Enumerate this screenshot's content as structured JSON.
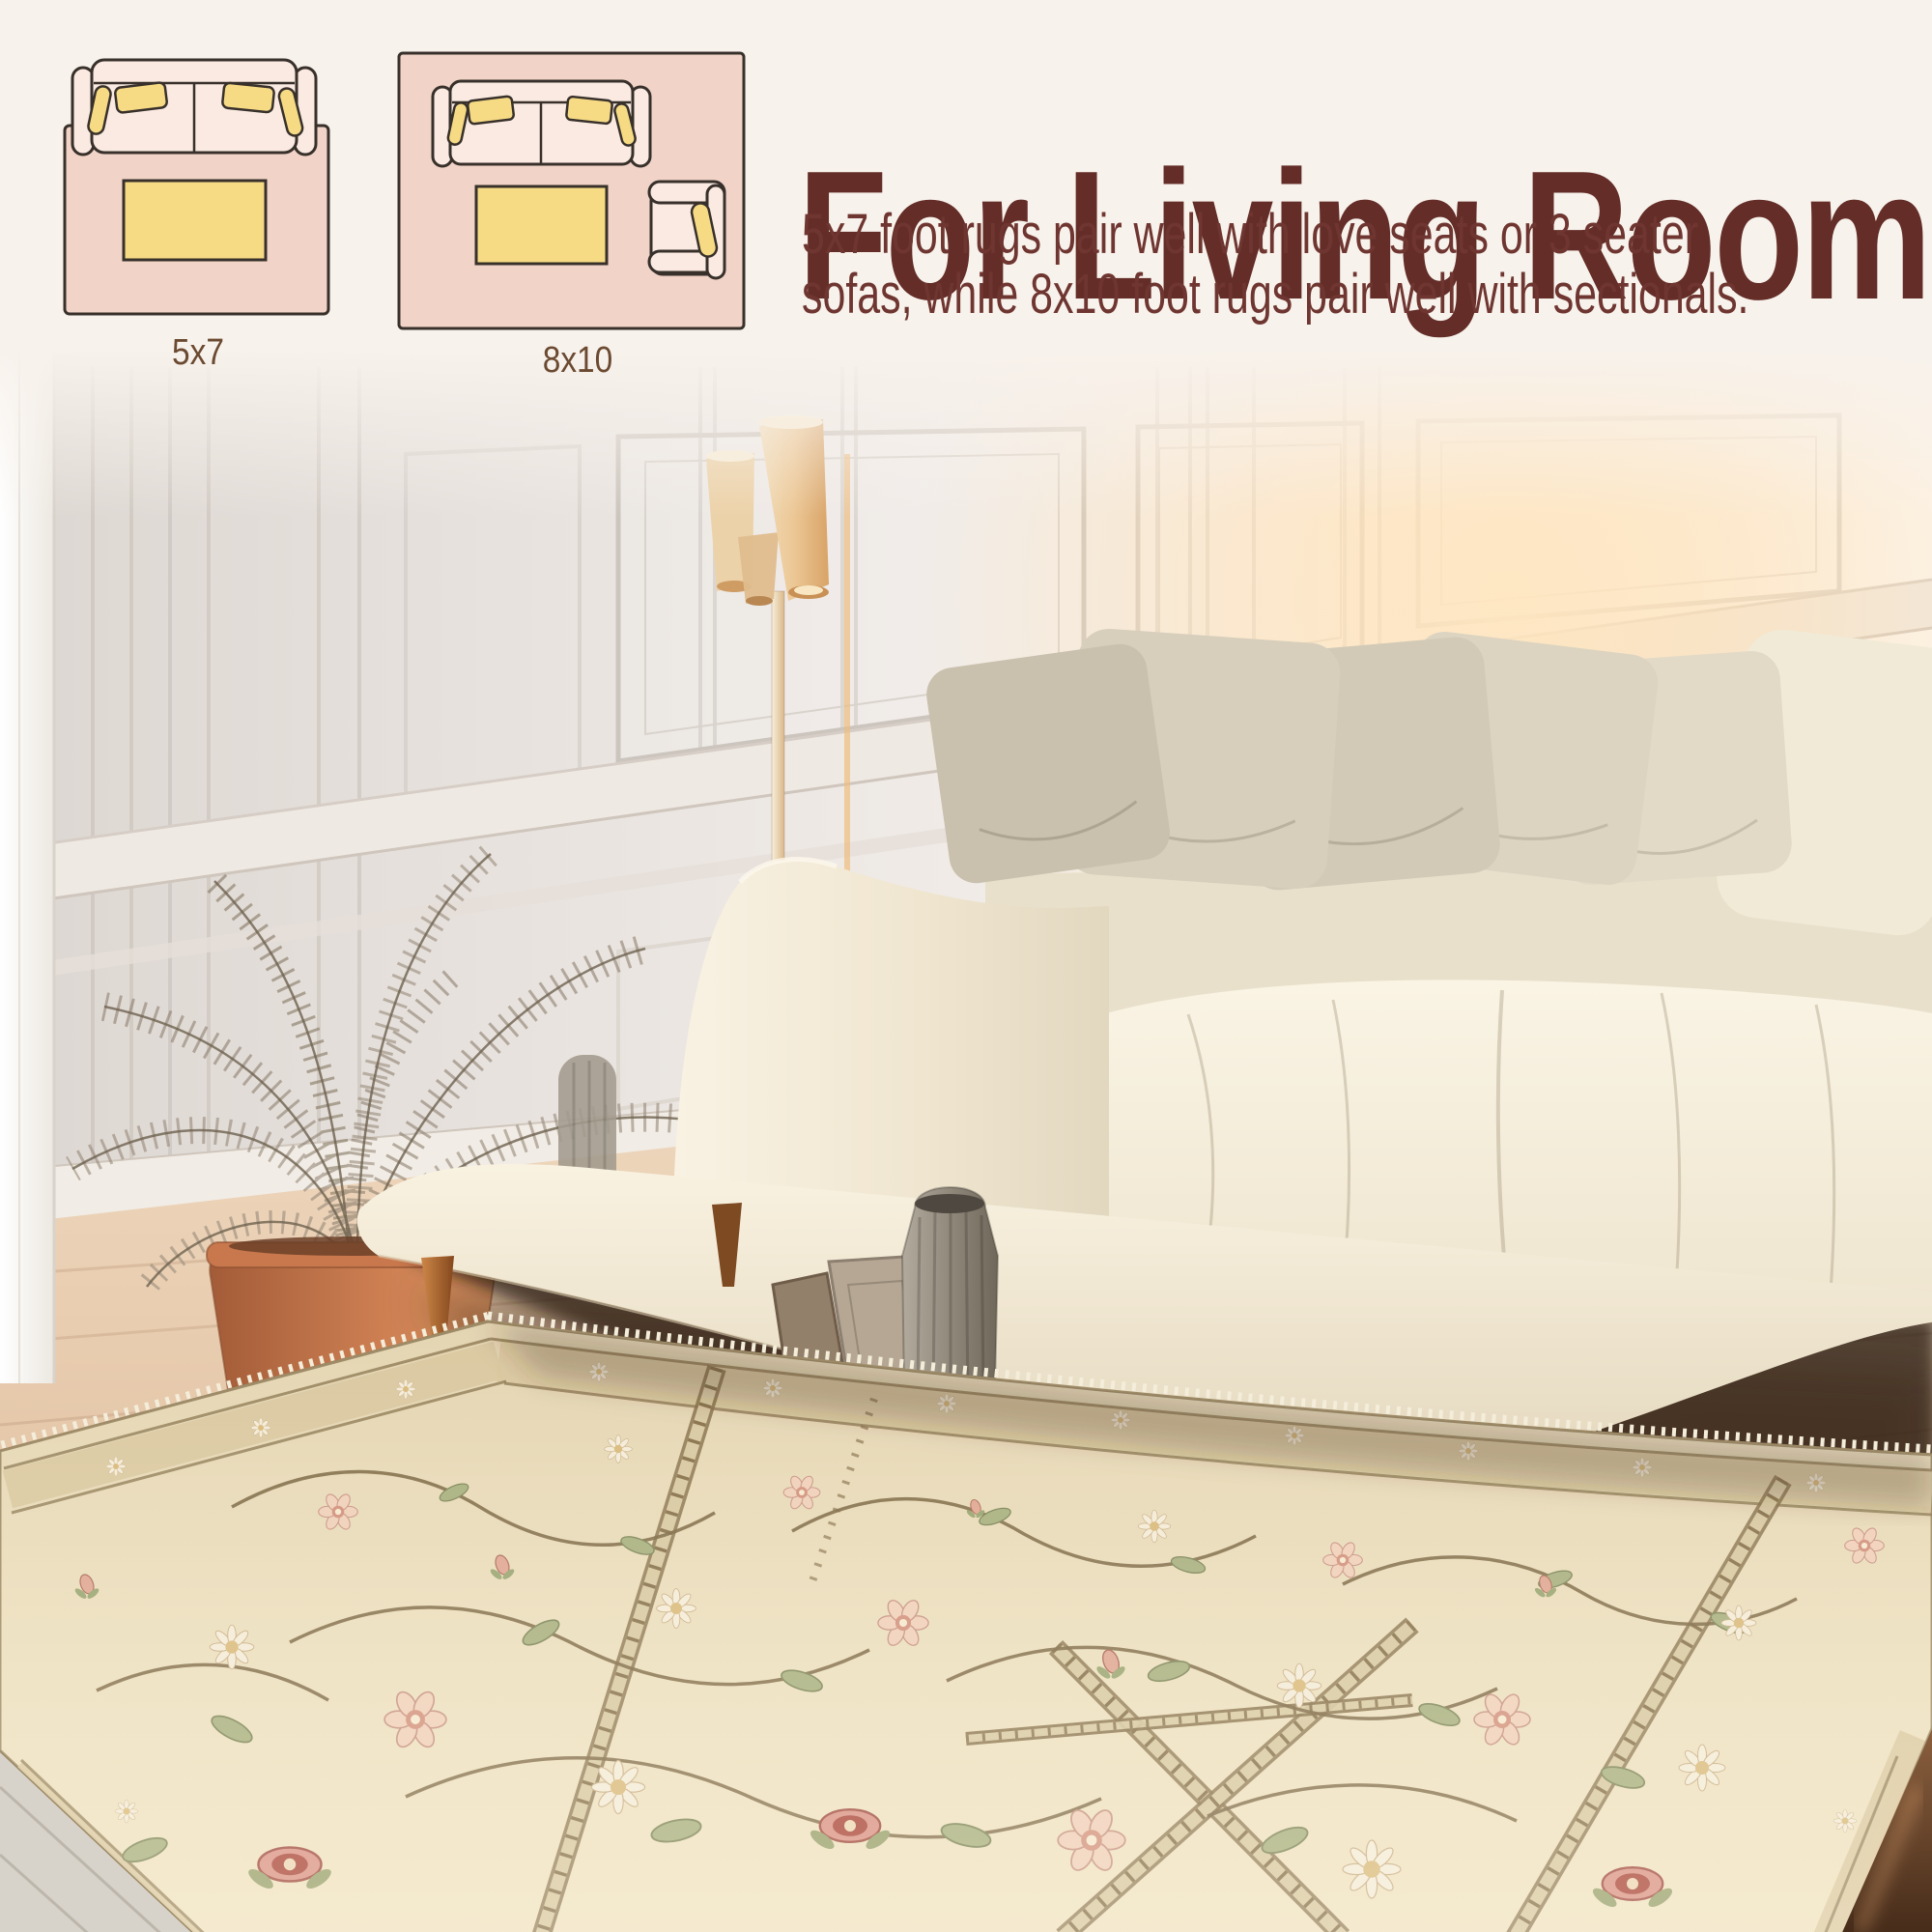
{
  "page": {
    "kind": "rug-size-guide-product-image",
    "background_color": "#f8f2ec"
  },
  "header": {
    "title": "For Living Room",
    "title_color": "#642d27",
    "description_line1": "5x7 foot rugs pair well with love seats or 3 seater",
    "description_line2": "sofas, while 8x10 foot rugs pair well with sectionals.",
    "text_color": "#6f3631"
  },
  "size_diagrams": {
    "outline_color": "#38302b",
    "rug_fill": "#f1d3c7",
    "furniture_fill": "#faeae1",
    "pillow_fill": "#f6db84",
    "label_color": "#6b4a31",
    "items": [
      {
        "label": "5x7",
        "furniture": [
          "loveseat-top-view",
          "coffee-table-top-view"
        ]
      },
      {
        "label": "8x10",
        "furniture": [
          "three-seat-sofa-top-view",
          "coffee-table-top-view",
          "armchair-top-view"
        ]
      }
    ]
  },
  "photo_scene": {
    "objects": [
      "white-paneled-wall",
      "left-door-frame",
      "three-shade-floor-lamp",
      "dried-palm-in-terracotta-pot",
      "stacked-books",
      "leaning-picture-frames",
      "pleated-floor-vase",
      "cream-fabric-sofa",
      "beige-throw-pillows",
      "wood-floor",
      "beige-floral-trellis-area-rug"
    ],
    "rug_colors": {
      "field": "#e9dbba",
      "border_band": "#d9c8a0",
      "vine": "#7d6845",
      "flower_pink": "#e9c2ae",
      "flower_red": "#a84438",
      "leaf_green": "#a8b07f"
    },
    "sunlight": "warm glow from upper right"
  }
}
